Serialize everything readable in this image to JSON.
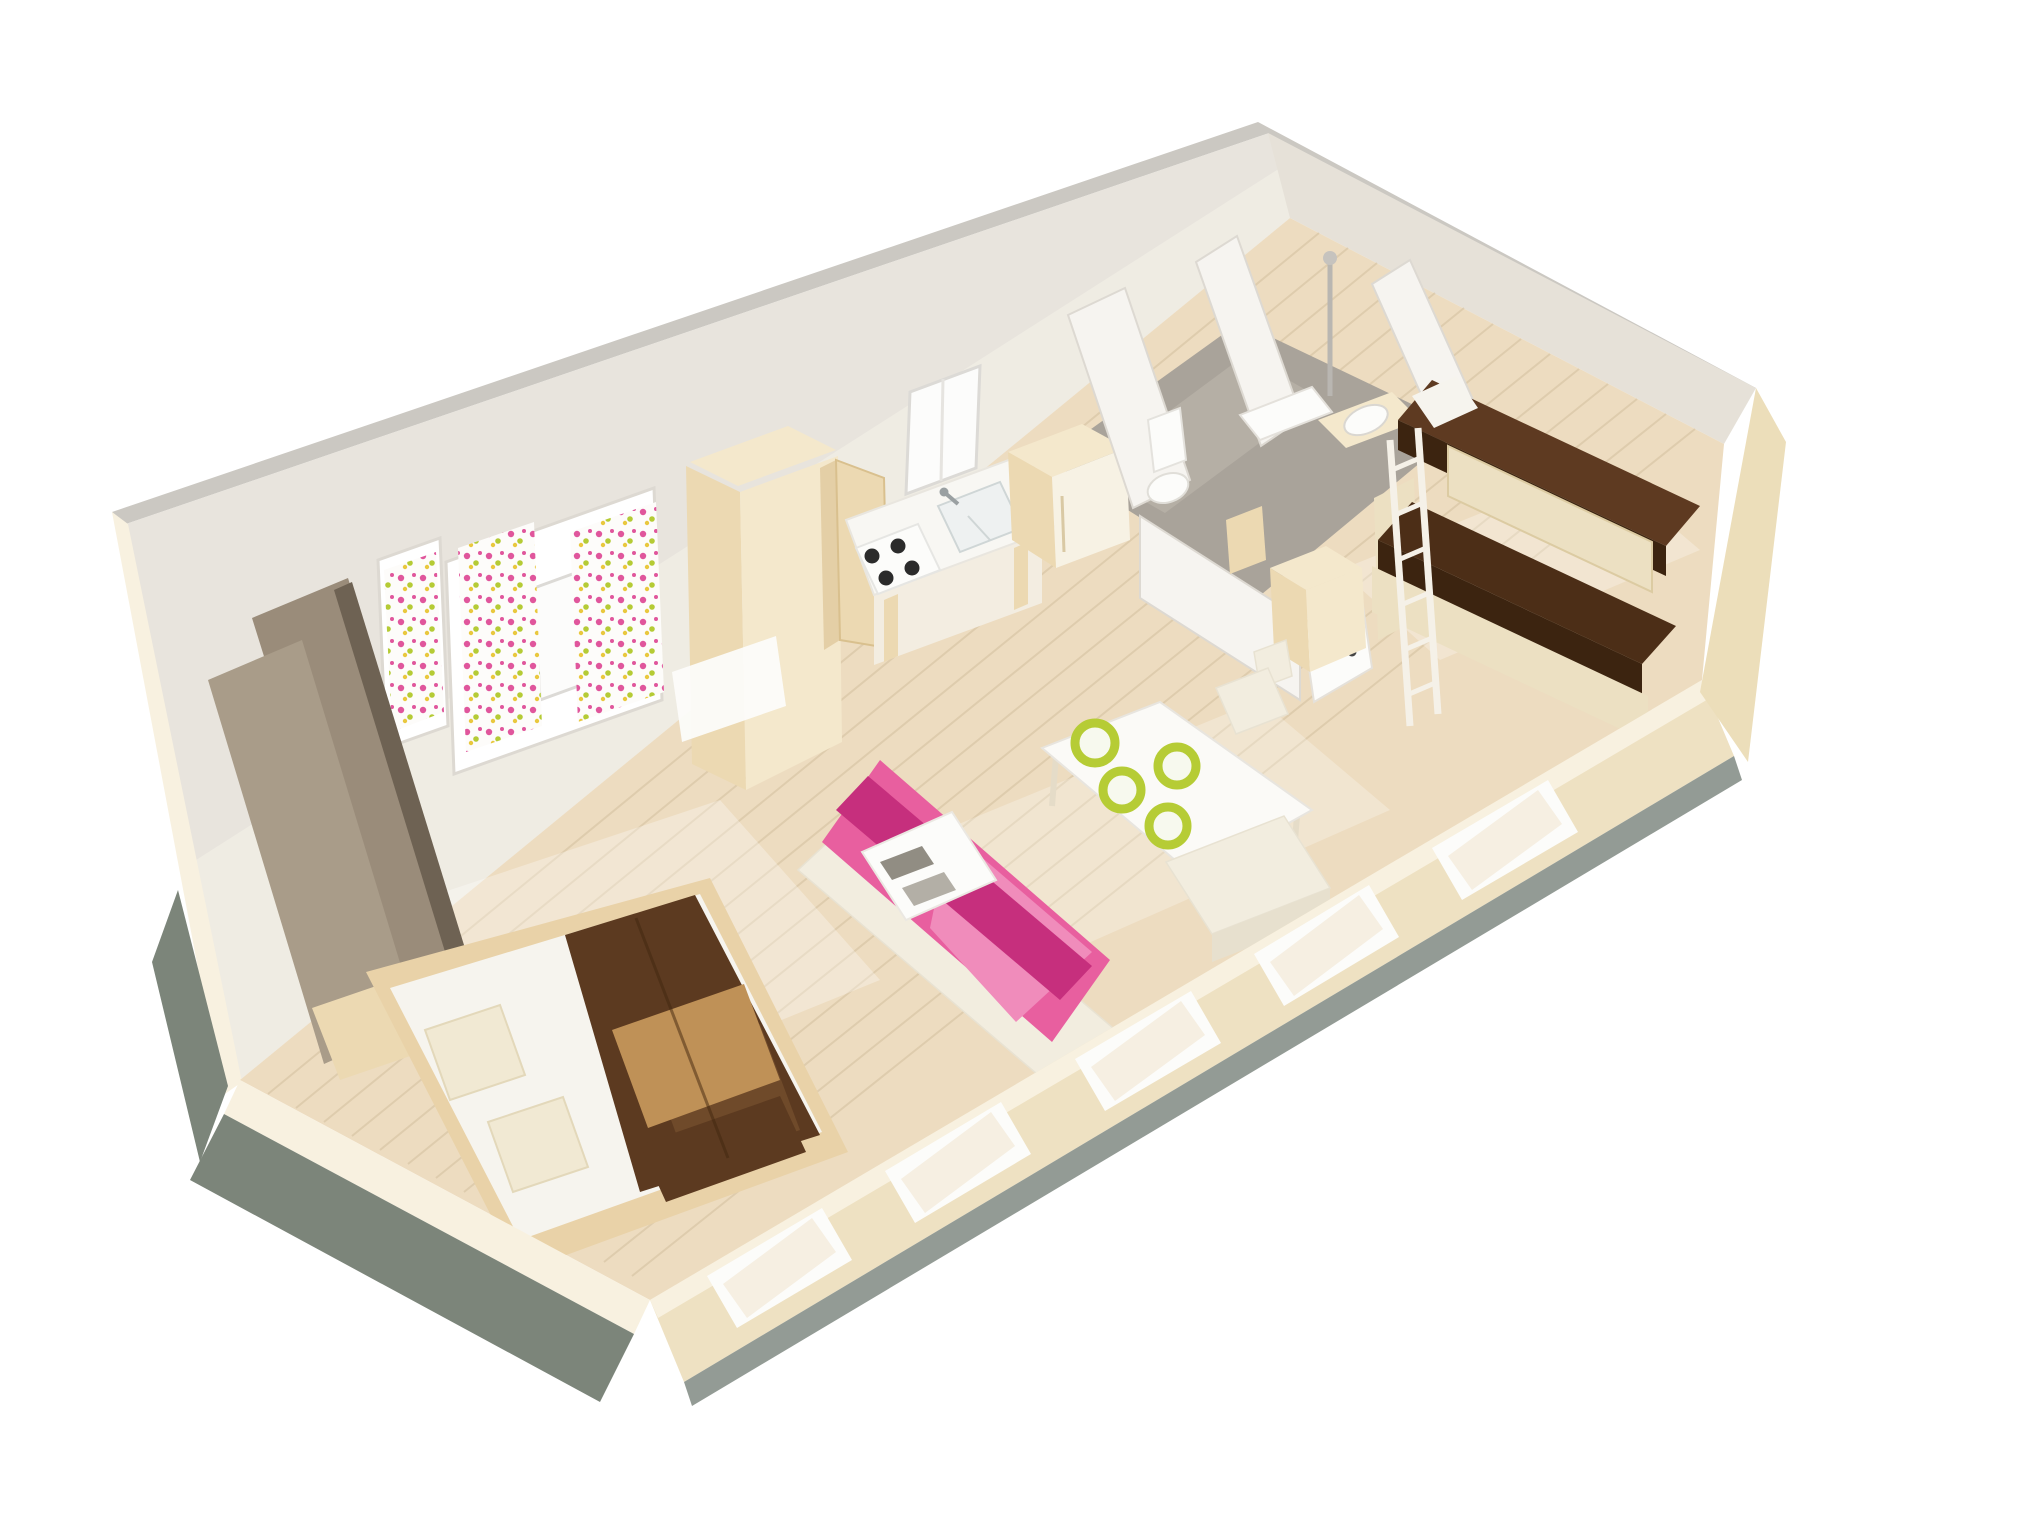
{
  "palette": {
    "background": "#ffffff",
    "wall_top": "#cbc8c2",
    "wall_face": "#e8e4dd",
    "wall_face_light": "#f3efe7",
    "wall_right_face": "#e6e1d8",
    "floor_wood": "#eddcc0",
    "plank_line": "#d3bf9e",
    "floor_patch": "#ffffff",
    "bath_floor": "#a9a39a",
    "bath_floor_light": "#beb8ae",
    "partition_white": "#f6f4f0",
    "partition_edge": "#ddd9d2",
    "cabinet_beige": "#ecd9b2",
    "cabinet_beige_light": "#f4e8cc",
    "cabinet_beige_dark": "#e0c89c",
    "counter_white": "#f8f7f3",
    "hob_burner": "#2b2b2b",
    "sink_steel": "#eef1f1",
    "window_frame": "#ffffff",
    "window_glass": "#fcfcfb",
    "curtain_white": "#fdfcfa",
    "dot_pink": "#e0569c",
    "dot_green": "#b5cb35",
    "dot_yellow": "#e9c83e",
    "wardrobe_mid": "#9a8c7a",
    "wardrobe_light": "#a99c89",
    "bed_frame_wood": "#e9d2a8",
    "mattress_white": "#f6f4ee",
    "pillow_cream": "#f1e9d3",
    "duvet_dark": "#5c3a20",
    "duvet_mid": "#6f4a2a",
    "duvet_tan": "#bf9157",
    "sofa_dark": "#c62f7d",
    "sofa_pink": "#e85f9f",
    "sofa_light": "#f08cbb",
    "table_white": "#fbfaf7",
    "bench_cream": "#f2eddf",
    "plate_green": "#b6cc35",
    "bunk_top_brown": "#5e3a21",
    "bunk_bottom_brown": "#4c2e17",
    "bunk_front_dark": "#3c2410",
    "bunk_rail_cream": "#ece0c2",
    "ladder_white": "#f5f1e8",
    "fixture_white": "#fcfcfa",
    "front_wall_cream": "#eee1c2",
    "front_wall_top": "#f8f1e0",
    "teal_edge": "#7c857a",
    "teal_base": "#87908a",
    "right_wall_exterior": "#ecdeba",
    "magazine_gray": "#918d83"
  },
  "scene": {
    "kind": "isometric-3d-floorplan-render",
    "rooms": [
      {
        "name": "bedroom",
        "items": [
          "double-bed",
          "brown-duvet",
          "two-pillows",
          "taupe-wardrobe",
          "bedside-bench",
          "floral-curtain-window",
          "side-curtain-window"
        ]
      },
      {
        "name": "kitchen",
        "items": [
          "tall-cupboard-open-door",
          "cooktop-four-burners",
          "sink-with-faucet",
          "kitchen-window",
          "fridge-cupboard"
        ]
      },
      {
        "name": "living-dining",
        "items": [
          "pink-sofa-bed",
          "coffee-table",
          "magazines",
          "white-dining-table",
          "four-lime-plates",
          "dining-bench",
          "dining-chair"
        ]
      },
      {
        "name": "bathroom",
        "items": [
          "shower-column",
          "shower-shelf",
          "toilet",
          "washbasin",
          "gray-floor",
          "open-door-with-handle",
          "partition-walls"
        ]
      },
      {
        "name": "kids-room",
        "items": [
          "bunk-beds",
          "white-ladder",
          "white-pillow",
          "storage-cabinet-open-door"
        ]
      },
      {
        "name": "shell",
        "items": [
          "white-back-walls",
          "low-front-wall",
          "five-white-window-openings",
          "teal-base-edges",
          "wood-plank-floor"
        ]
      }
    ]
  }
}
